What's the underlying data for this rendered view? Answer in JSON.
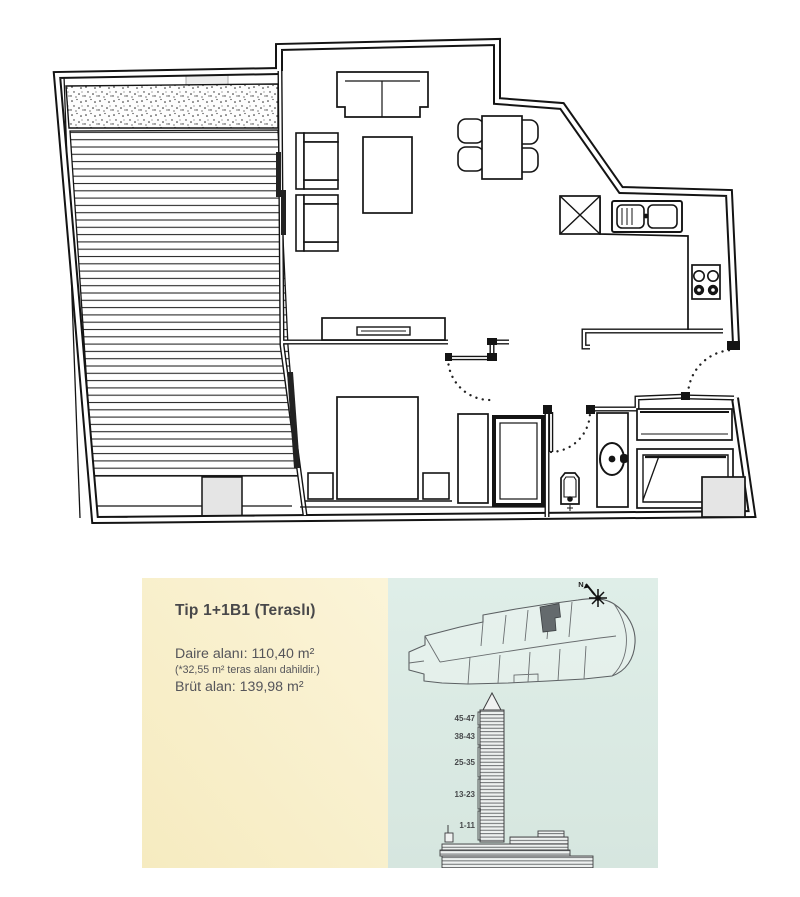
{
  "page": {
    "background": "#ffffff"
  },
  "colors": {
    "plan_line": "#141414",
    "shaft_fill": "#e5e5e5",
    "panel_left_bg_start": "#fbf4d8",
    "panel_left_bg_end": "#f6ebc0",
    "panel_right_bg_start": "#dfeee8",
    "panel_right_bg_end": "#d6e6df",
    "key_plan_highlight": "#646a6d",
    "text": "#4b4b4d"
  },
  "info_panel": {
    "title": "Tip 1+1B1 (Teraslı)",
    "area_line": "Daire alanı: 110,40 m²",
    "area_note": "(*32,55 m² teras alanı dahildir.)",
    "gross_line": "Brüt alan: 139,98 m²"
  },
  "site_panel": {
    "compass_label": "N",
    "tower_floor_ranges": [
      "45-47",
      "38-43",
      "25-35",
      "13-23",
      "1-11"
    ]
  }
}
